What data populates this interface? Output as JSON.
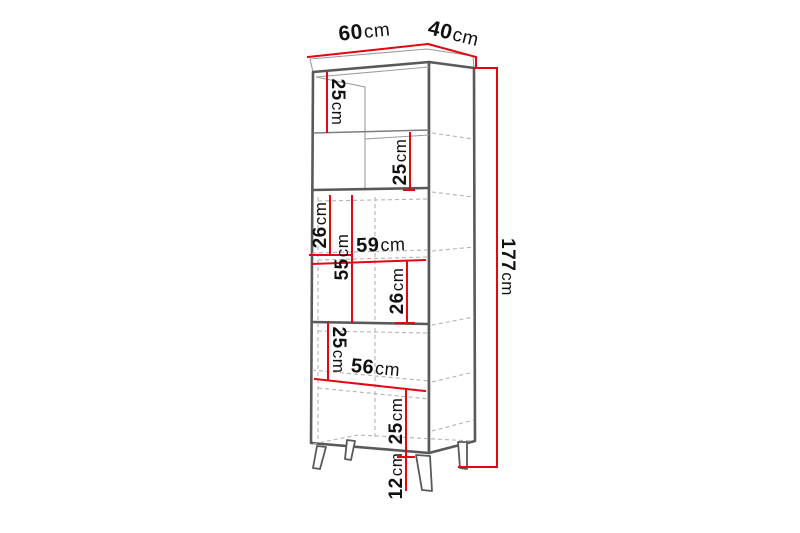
{
  "page": {
    "background_color": "#ffffff"
  },
  "diagram": {
    "type": "furniture-dimension-drawing",
    "subject": "tall-cabinet-with-legs",
    "accent_color": "#e30613",
    "text_color": "#111111",
    "dimensions": {
      "top_width": {
        "value": "60",
        "unit": "cm"
      },
      "top_depth": {
        "value": "40",
        "unit": "cm"
      },
      "total_height": {
        "value": "177",
        "unit": "cm"
      },
      "upper_section_1": {
        "value": "25",
        "unit": "cm"
      },
      "upper_section_2": {
        "value": "25",
        "unit": "cm"
      },
      "middle_left": {
        "value": "26",
        "unit": "cm"
      },
      "middle_height": {
        "value": "55",
        "unit": "cm"
      },
      "interior_width_middle": {
        "value": "59",
        "unit": "cm"
      },
      "middle_right": {
        "value": "26",
        "unit": "cm"
      },
      "lower_left": {
        "value": "25",
        "unit": "cm"
      },
      "interior_width_lower": {
        "value": "56",
        "unit": "cm"
      },
      "lower_right": {
        "value": "25",
        "unit": "cm"
      },
      "leg_height": {
        "value": "12",
        "unit": "cm"
      }
    }
  }
}
